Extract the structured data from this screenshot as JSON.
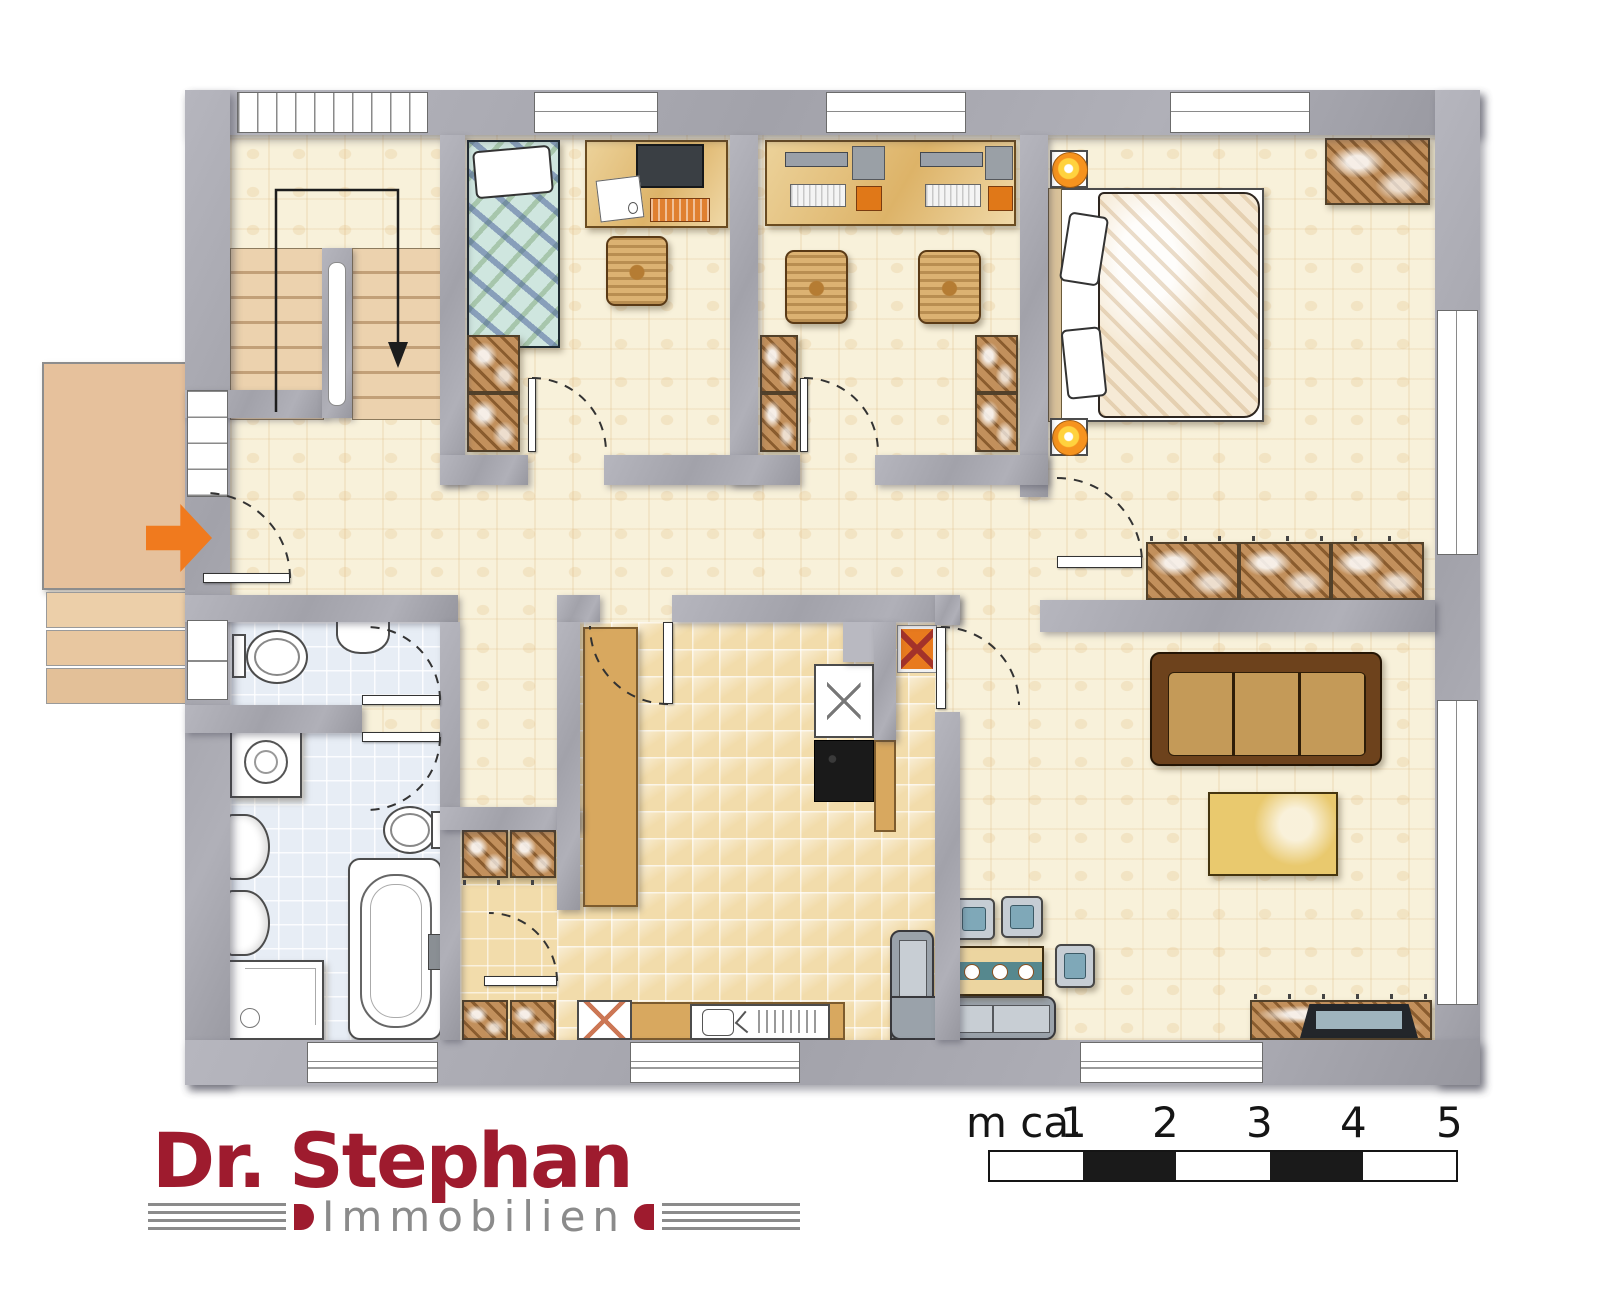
{
  "branding": {
    "title": "Dr. Stephan",
    "subtitle": "Immobilien"
  },
  "scalebar": {
    "unit_label": "m ca.",
    "ticks": [
      "1",
      "2",
      "3",
      "4",
      "5"
    ]
  },
  "colors": {
    "wall": "#a2a2aa",
    "parquet": "#f8f1da",
    "tile_warm": "#f2dcab",
    "tile_cool": "#e7edf5",
    "counter": "#d8a85f",
    "cabinet": "#c2905c",
    "arrow_orange": "#f07a1e",
    "accent_orange": "#f6931e",
    "stove_black": "#1a1a1a",
    "logo_red": "#9e1b2e",
    "logo_gray": "#8b8b8b"
  }
}
